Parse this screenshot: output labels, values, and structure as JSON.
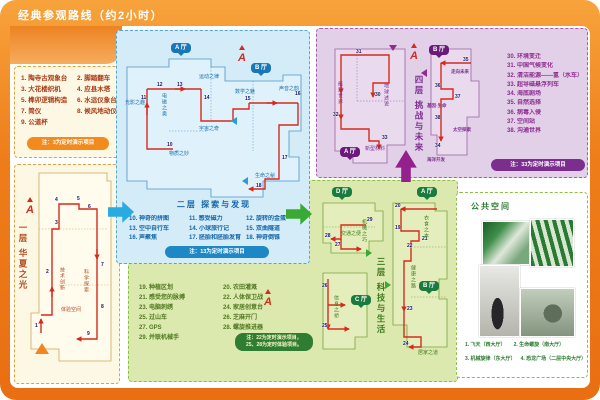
{
  "palette": {
    "frame_orange": "#EE7D19",
    "floor1_text": "#A93B17",
    "floor2_text": "#1566A8",
    "floor3_text": "#4F7A1E",
    "floor4_text": "#8E2D8E",
    "route_red": "#D42B1E",
    "hall_blue": "#1877B8",
    "hall_green": "#1B7A3D",
    "hall_purple": "#6A1B7A"
  },
  "header": {
    "title": "经典参观路线（约2小时）"
  },
  "compass": "A",
  "floor1": {
    "map_title": "一层 华夏之光",
    "items": [
      "1. 陶寺古观象台",
      "2. 脚踏翻车",
      "3. 大花楼织机",
      "4. 应县木塔",
      "5. 榫卯逻辑构造",
      "6. 水运仪象台",
      "7. 简仪",
      "8. 候风地动仪",
      "9. 公道杯"
    ],
    "note": "注：3为定时演示项目",
    "areas": [
      "技术创新",
      "科学探索",
      "体验空间"
    ],
    "points": [
      "1",
      "2",
      "3",
      "4",
      "5",
      "6",
      "7",
      "8",
      "9"
    ]
  },
  "floor2": {
    "map_title": "二层 探索与发现",
    "halls": [
      "A 厅",
      "B 厅"
    ],
    "areas": [
      "物质之妙",
      "光影之趣",
      "电磁之奥",
      "宇宙之奇",
      "数学之魅",
      "声音之韵",
      "生命之秘",
      "运动之律"
    ],
    "items": [
      "10. 神奇的拼图",
      "11. 感受磁力",
      "12. 旋转的金蛋",
      "13. 空中自行车",
      "14. 小球旅行记",
      "15. 双曲隧道",
      "16. 声聚焦",
      "17. 胚胎和胚胎发育",
      "18. 神奇倒锥"
    ],
    "note": "注：13为定时演示项目",
    "points": [
      "10",
      "11",
      "12",
      "13",
      "14",
      "15",
      "16",
      "17",
      "18"
    ]
  },
  "floor3": {
    "map_title": "三层 科技与生活",
    "halls": [
      "D 厅",
      "A 厅",
      "B 厅",
      "C 厅"
    ],
    "areas": [
      "交通之便",
      "机械之巧",
      "信息之桥",
      "衣食之本",
      "健康之路",
      "居家之道"
    ],
    "items": [
      "19. 种植区划",
      "20. 农田灌溉",
      "21. 感受您的脉搏",
      "22. 人体保卫战",
      "23. 电脑刺绣",
      "24. 家居创意台",
      "25. 过山车",
      "26. 芝麻开门",
      "27. GPS",
      "28. 螺旋推进器",
      "29. 并联机械手"
    ],
    "note_line1": "注：22为定时演示项目，",
    "note_line2": "25、28为定时体验项目。",
    "points": [
      "19",
      "20",
      "21",
      "22",
      "23",
      "24",
      "25",
      "26",
      "27",
      "28",
      "29"
    ]
  },
  "floor4": {
    "map_title": "四层 挑战与未来",
    "halls": [
      "A 厅",
      "B 厅"
    ],
    "areas": [
      "能源世界",
      "地球述说",
      "新型材料",
      "走向未来",
      "基因·生命",
      "太空探索",
      "海洋开发"
    ],
    "items": [
      "30. 环境变迁",
      "31. 中国气候变化",
      "32. 清洁能源——氢（水车）",
      "33. 超导磁悬浮列车",
      "34. 海底剧场",
      "35. 自然选择",
      "36. 病毒入侵",
      "37. 空间站",
      "38. 沟通世界"
    ],
    "note": "注：33为定时演示项目",
    "points": [
      "30",
      "31",
      "32",
      "33",
      "34",
      "35",
      "36",
      "37",
      "38"
    ]
  },
  "public": {
    "title": "公共空间",
    "captions": [
      "1. 飞天（西大厅）",
      "2. 生命螺旋（南大厅）",
      "3. 机械旋律（东大厅）",
      "4. 恐龙广场（二层中央大厅）"
    ]
  }
}
